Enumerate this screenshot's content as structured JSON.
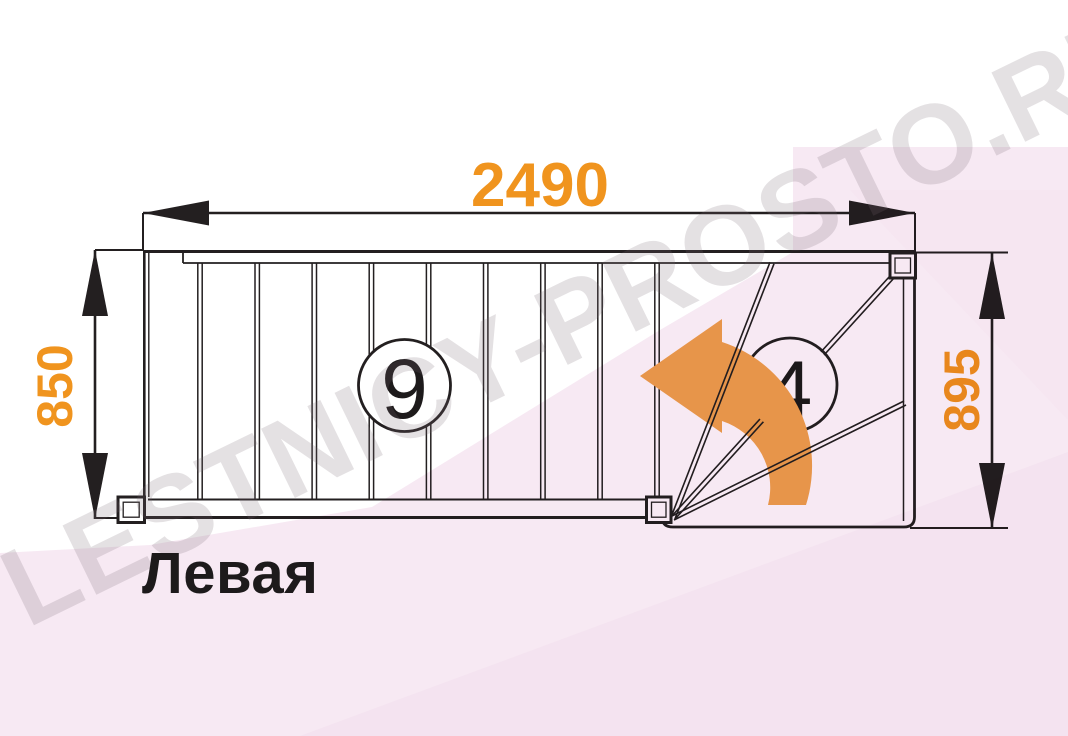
{
  "caption": {
    "label": "Левая"
  },
  "watermark": {
    "text": "LESTNICY-PROSTO.RU"
  },
  "dimensions": {
    "top_width": "2490",
    "left_height": "850",
    "right_height": "895"
  },
  "steps": {
    "straight_flight_count": "9",
    "winder_count": "4"
  },
  "diagram_info": {
    "type": "staircase-floor-plan",
    "turn_direction": "left",
    "straight_steps": 9,
    "winder_steps": 4
  },
  "colors": {
    "dimension_orange": "#F0941E",
    "arrow_orange": "#EFA34D",
    "line_black": "#231F20",
    "pink_tint": "#F7E9F3",
    "pink_tint_deep": "#F3DEEC",
    "watermark_gray": "#D8D2D6"
  }
}
